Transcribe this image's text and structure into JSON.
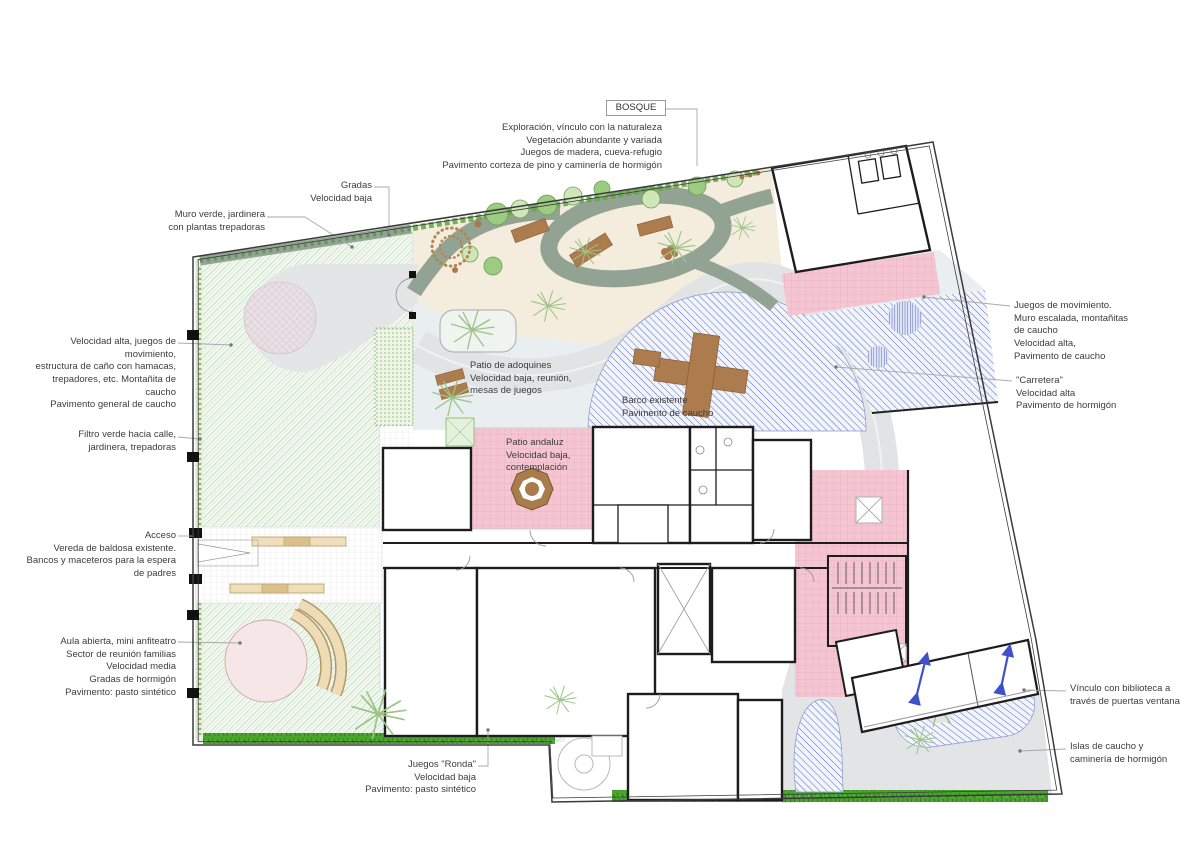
{
  "plan": {
    "title_box": "BOSQUE",
    "notes": {
      "bosque": "Exploración, vínculo con la naturaleza\nVegetación abundante y variada\nJuegos de madera, cueva-refugio\nPavimento corteza de pino y caminería de hormigón",
      "gradas": "Gradas\nVelocidad baja",
      "muro_verde": "Muro verde, jardinera\ncon plantas trepadoras",
      "velocidad_alta": "Velocidad alta, juegos de movimiento,\nestructura de caño con hamacas,\ntrepadores, etc. Montañita de caucho\nPavimento general de caucho",
      "filtro_verde": "Filtro verde hacia calle,\njardinera, trepadoras",
      "acceso": "Acceso\nVereda de baldosa existente.\nBancos y maceteros para la espera\nde padres",
      "aula_abierta": "Aula abierta, mini anfiteatro\nSector de reunión familias\nVelocidad media\nGradas de hormigón\nPavimento: pasto sintético",
      "juegos_ronda": "Juegos \"Ronda\"\nVelocidad baja\nPavimento: pasto sintético",
      "juegos_movimiento": "Juegos de movimiento.\nMuro escalada, montañitas\nde caucho\nVelocidad alta,\nPavimento de caucho",
      "carretera": "\"Carretera\"\nVelocidad alta\nPavimento de hormigón",
      "vinculo_biblioteca": "Vínculo con biblioteca a\ntravés de puertas ventana",
      "islas_caucho": "Islas de caucho y\ncaminería de hormigón",
      "patio_adoquines": "Patio de adoquines\nVelocidad baja, reunión,\nmesas de juegos",
      "barco": "Barco existente\nPavimento de caucho",
      "patio_andaluz": "Patio andaluz\nVelocidad baja,\ncontemplación"
    },
    "colors": {
      "pasto_sintetico_hatch": "#a6cba2",
      "caucho_azul": "#5568bd",
      "patio_rosa": "#f5c6d2",
      "sendero_sage": "#93a393",
      "hormigon_gris": "#e2e4e5",
      "madera": "#ad7c4e",
      "pasto_natural": "#4aa52f",
      "suelo_bosque": "#f4edde",
      "zona_celeste": "#e9eef1",
      "flecha_azul": "#3f51c9"
    }
  }
}
